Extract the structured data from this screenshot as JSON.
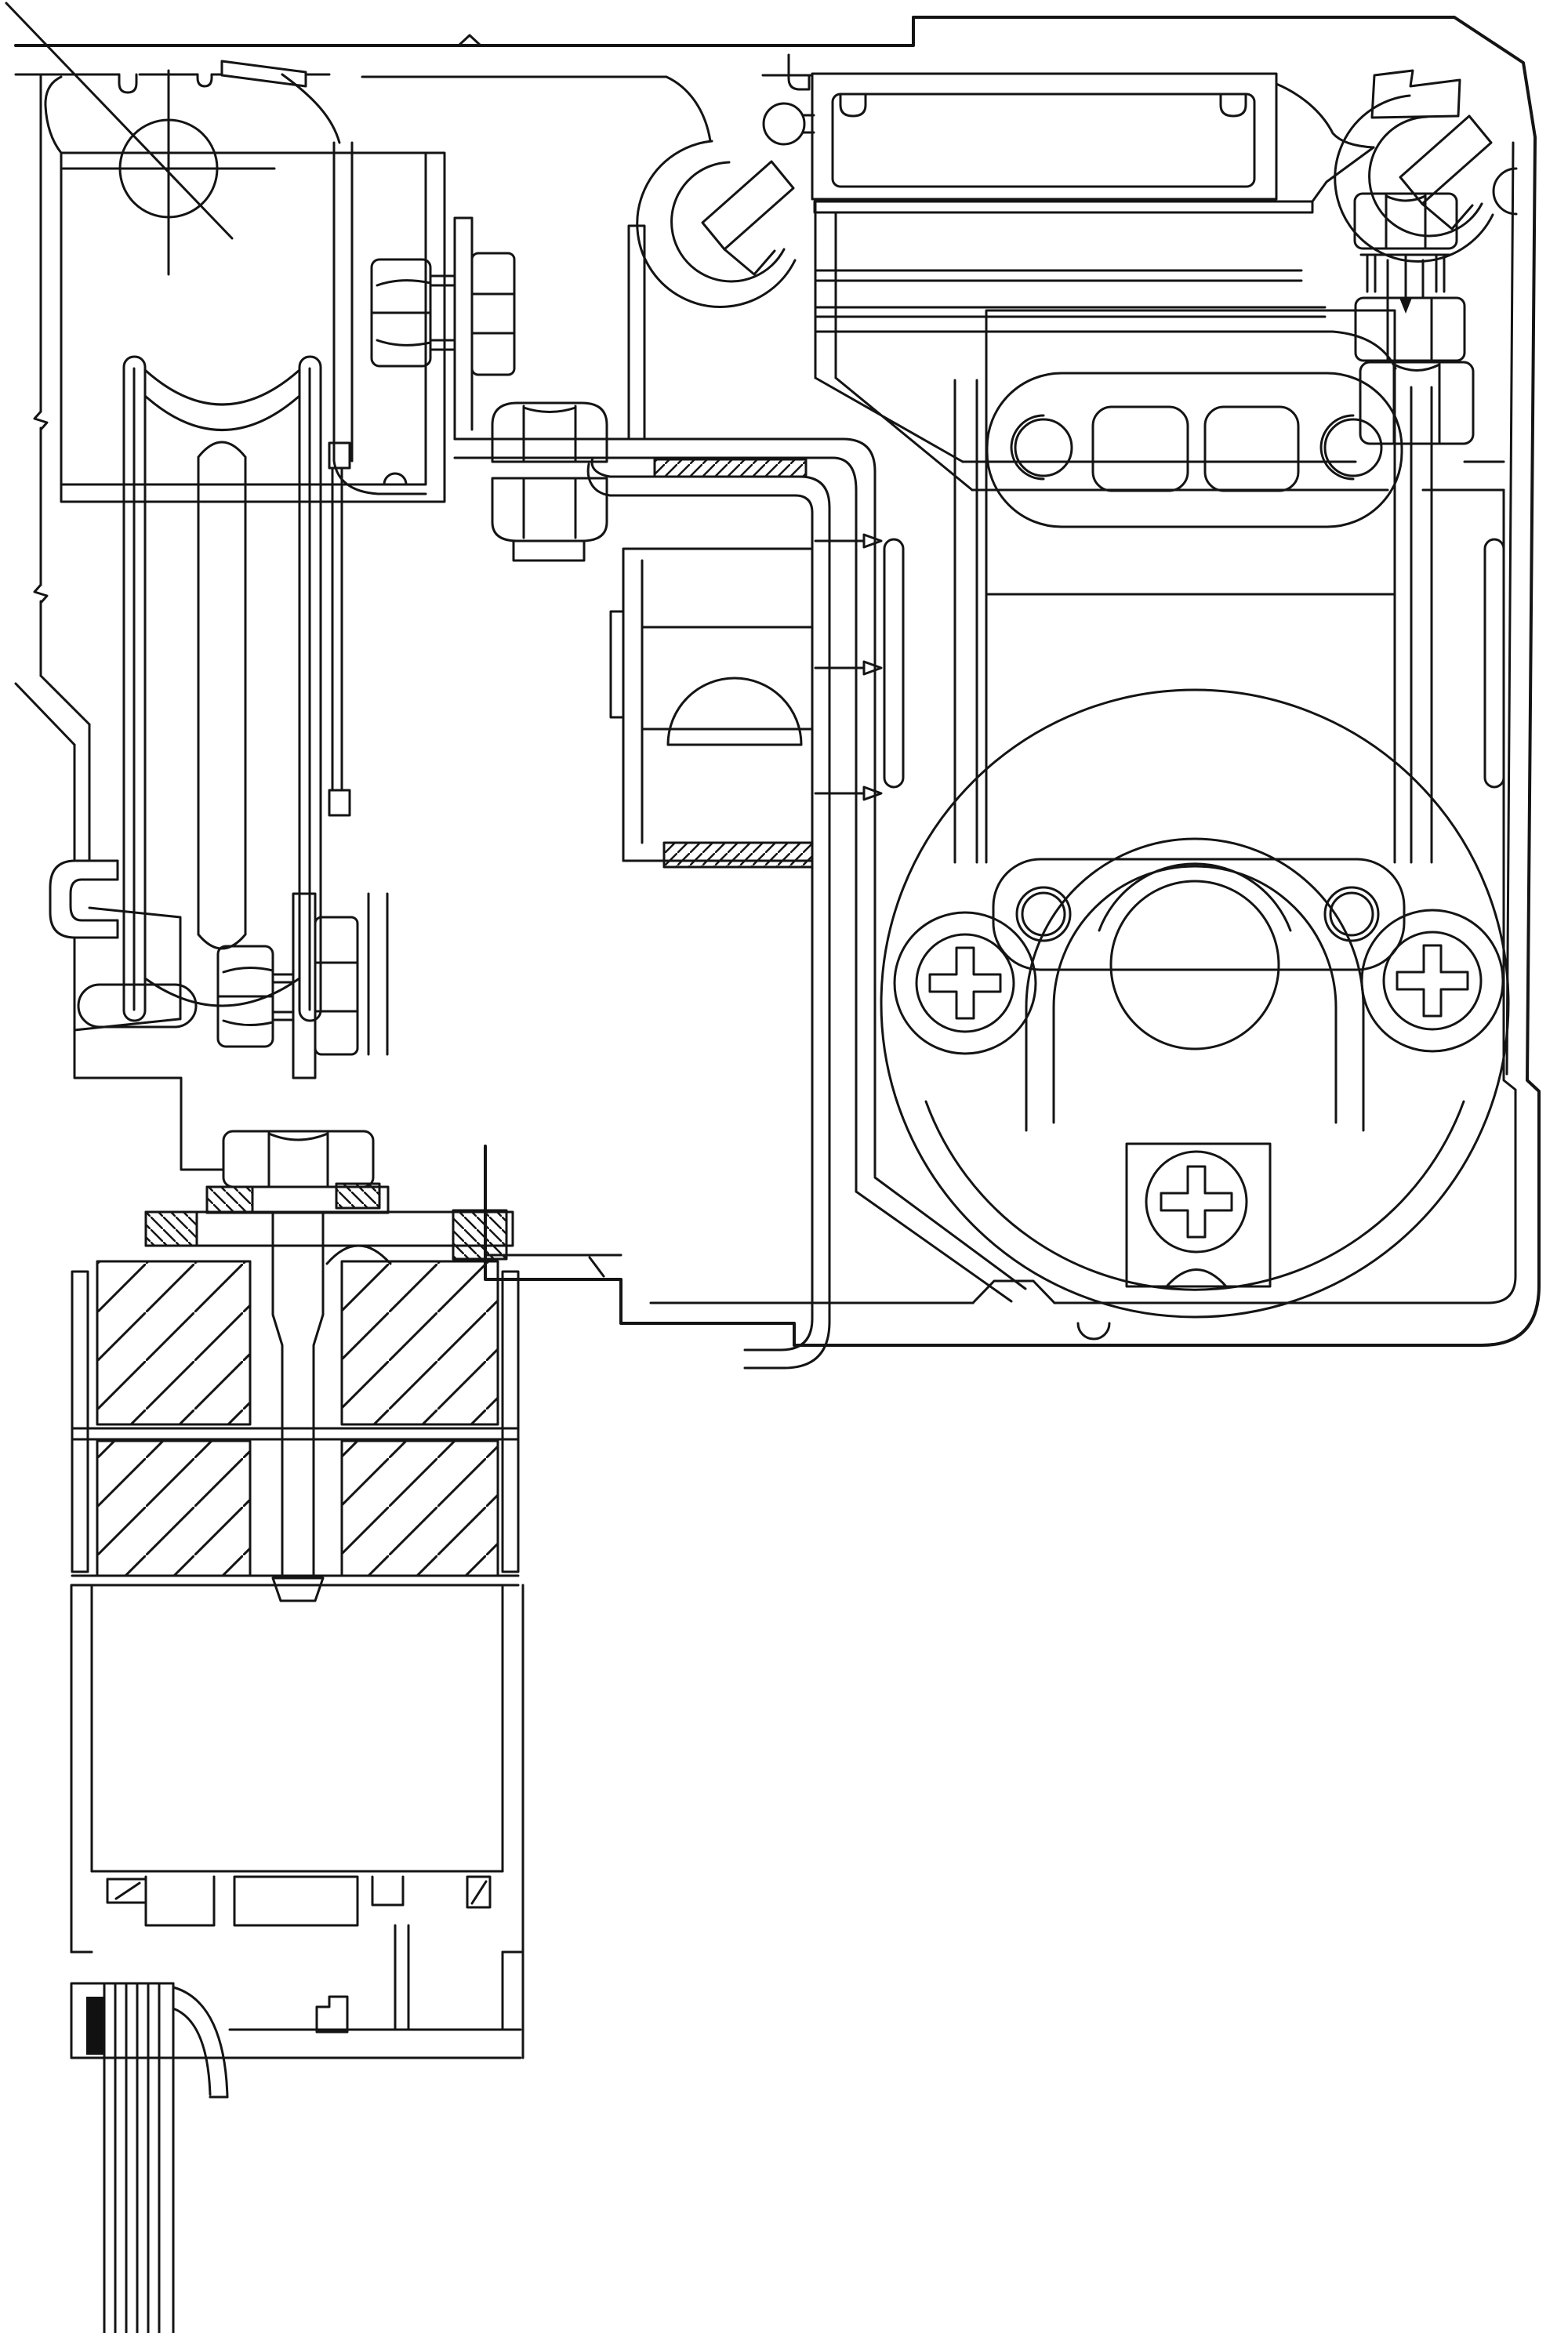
{
  "document": {
    "kind": "technical-cad-section-drawing",
    "description": "Black and white CAD cross-section drawing of an aluminium sliding-door frame with roller carriage, clamp bolts, glazing stack, bottom rail with brush seal, and motor drive housing",
    "background_color": "#ffffff",
    "ink_color": "#141414",
    "gasket_color": "#111111"
  },
  "drawing": {
    "has_text": false,
    "hatch_styles": {
      "fine_ne": {
        "angle": 45,
        "spacing_px": 16
      },
      "fine_nw": {
        "angle": -45,
        "spacing_px": 16
      },
      "coarse_ne": {
        "angle": 45,
        "spacing_px": 62
      }
    },
    "components": [
      {
        "id": "section-cut-marker",
        "label": "Section cut centre marker"
      },
      {
        "id": "head-frame-profile",
        "label": "Outer aluminium head frame profile"
      },
      {
        "id": "top-left-chamber",
        "label": "Hollow chamber of left jamb profile"
      },
      {
        "id": "screw-boss-left",
        "label": "C-shaped screw boss (left)"
      },
      {
        "id": "screw-boss-right",
        "label": "C-shaped screw boss (top right)"
      },
      {
        "id": "roller-wheel",
        "label": "Grooved roller wheel (section)"
      },
      {
        "id": "roller-carrier",
        "label": "Roller carrier bracket"
      },
      {
        "id": "adjustment-bolt-upper",
        "label": "Horizontal adjustment bolt with nut"
      },
      {
        "id": "adjustment-bolt-lower",
        "label": "Lower horizontal bolt with washer and nut"
      },
      {
        "id": "l-bracket",
        "label": "L-shaped mounting bracket"
      },
      {
        "id": "nut-stack",
        "label": "Stacked hex nuts on vertical stud"
      },
      {
        "id": "spacer-block",
        "label": "Central spacer block with gasket strips"
      },
      {
        "id": "clamp-plate",
        "label": "Glazing clamp plate with hatched packers"
      },
      {
        "id": "clamp-bolt",
        "label": "Large vertical clamp bolt"
      },
      {
        "id": "glazing-stack",
        "label": "Insulated glazing packer blocks (hatched)"
      },
      {
        "id": "bottom-rail",
        "label": "Bottom rail profile with interlock teeth"
      },
      {
        "id": "brush-seal",
        "label": "Brush / wire seal bundle with black gasket"
      },
      {
        "id": "drive-housing",
        "label": "Drive / lock housing with motor circle"
      },
      {
        "id": "slotted-plate-upper",
        "label": "Upper slotted fixing plate"
      },
      {
        "id": "slotted-plate-lower",
        "label": "Lower slotted fixing plate"
      },
      {
        "id": "motor-circle",
        "label": "Large drive wheel circle"
      },
      {
        "id": "phillips-screw-left",
        "label": "Phillips screw (left)"
      },
      {
        "id": "phillips-screw-right",
        "label": "Phillips screw (right)"
      },
      {
        "id": "phillips-screw-bottom",
        "label": "Phillips screw (bottom centre)"
      },
      {
        "id": "fixing-bolt-top-right",
        "label": "Top-right fixing bolt with arrow"
      }
    ]
  }
}
